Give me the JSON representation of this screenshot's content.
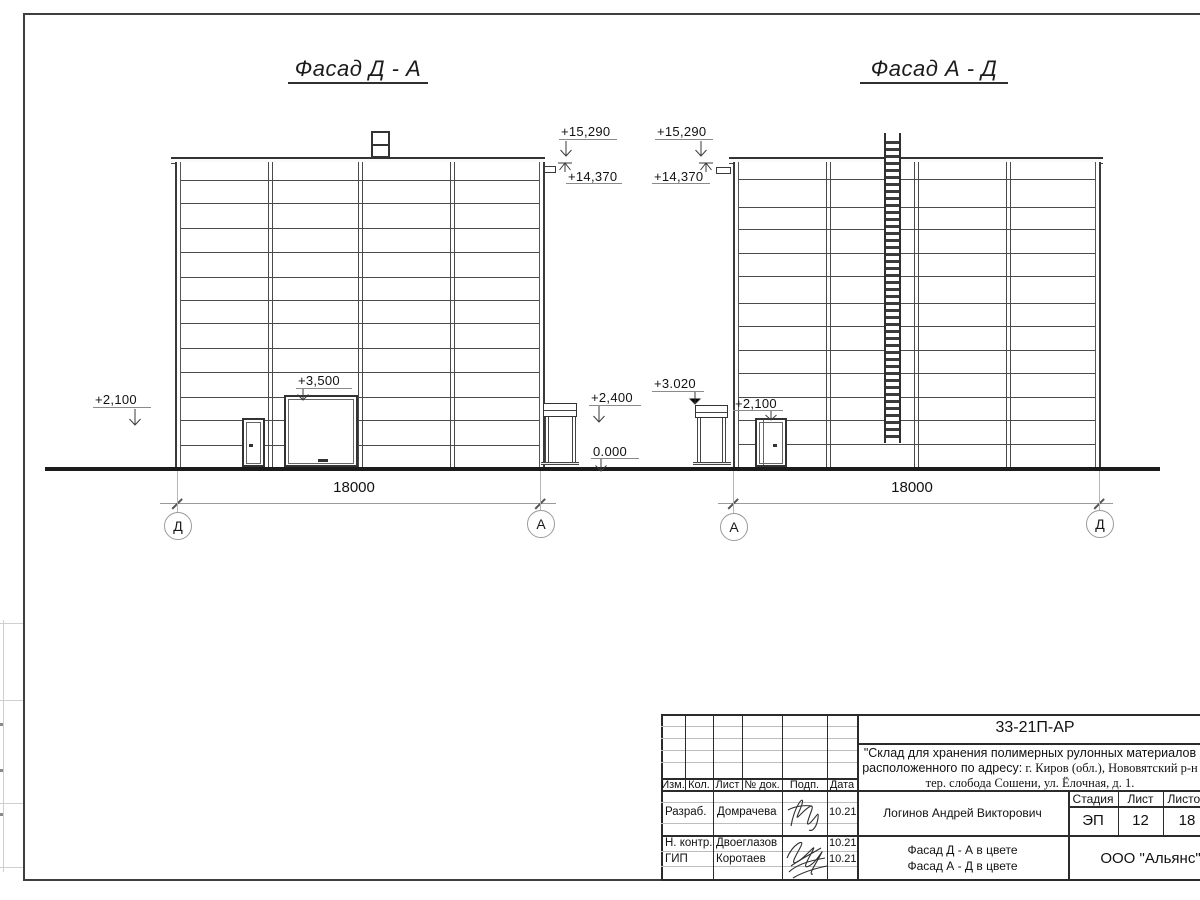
{
  "facade1": {
    "title": "Фасад Д - А",
    "dim": "18000",
    "axis_left": "Д",
    "axis_right": "А",
    "e15290": "+15,290",
    "e14370": "+14,370",
    "e3500": "+3,500",
    "e2100": "+2,100",
    "e2400": "+2,400",
    "e0": "0.000"
  },
  "facade2": {
    "title": "Фасад А - Д",
    "dim": "18000",
    "axis_left": "А",
    "axis_right": "Д",
    "e15290": "+15,290",
    "e14370": "+14,370",
    "e3020": "+3.020",
    "e2100": "+2,100"
  },
  "titleblock": {
    "doc_number": "33-21П-АР",
    "project_line1": "\"Склад для хранения полимерных рулонных материалов",
    "project_line2_sans": "расположенного по адресу:",
    "project_line2_serif": " г. Киров (обл.), Нововятский р-н",
    "project_line3": "тер. слобода Сошени, ул. Ёлочная, д. 1.",
    "col_izm": "Изм.",
    "col_kol": "Кол.",
    "col_list": "Лист",
    "col_ndok": "№ док.",
    "col_podp": "Подп.",
    "col_data": "Дата",
    "rows": [
      {
        "role": "Разраб.",
        "name": "Домрачева",
        "date": "10.21"
      },
      {
        "role": "Н. контр.",
        "name": "Двоеглазов",
        "date": "10.21"
      },
      {
        "role": "ГИП",
        "name": "Коротаев",
        "date": "10.21"
      }
    ],
    "chief_name": "Логинов Андрей Викторович",
    "stage_label": "Стадия",
    "sheet_label": "Лист",
    "sheets_label": "Листов",
    "stage": "ЭП",
    "sheet_no": "12",
    "sheets_total": "18",
    "drawing_name1": "Фасад Д - А в цвете",
    "drawing_name2": "Фасад А - Д в цвете",
    "company": "ООО \"Альянс\"",
    "signature1_icon": "signature-scribble-icon",
    "signature2_icon": "signature-scribble-icon"
  }
}
